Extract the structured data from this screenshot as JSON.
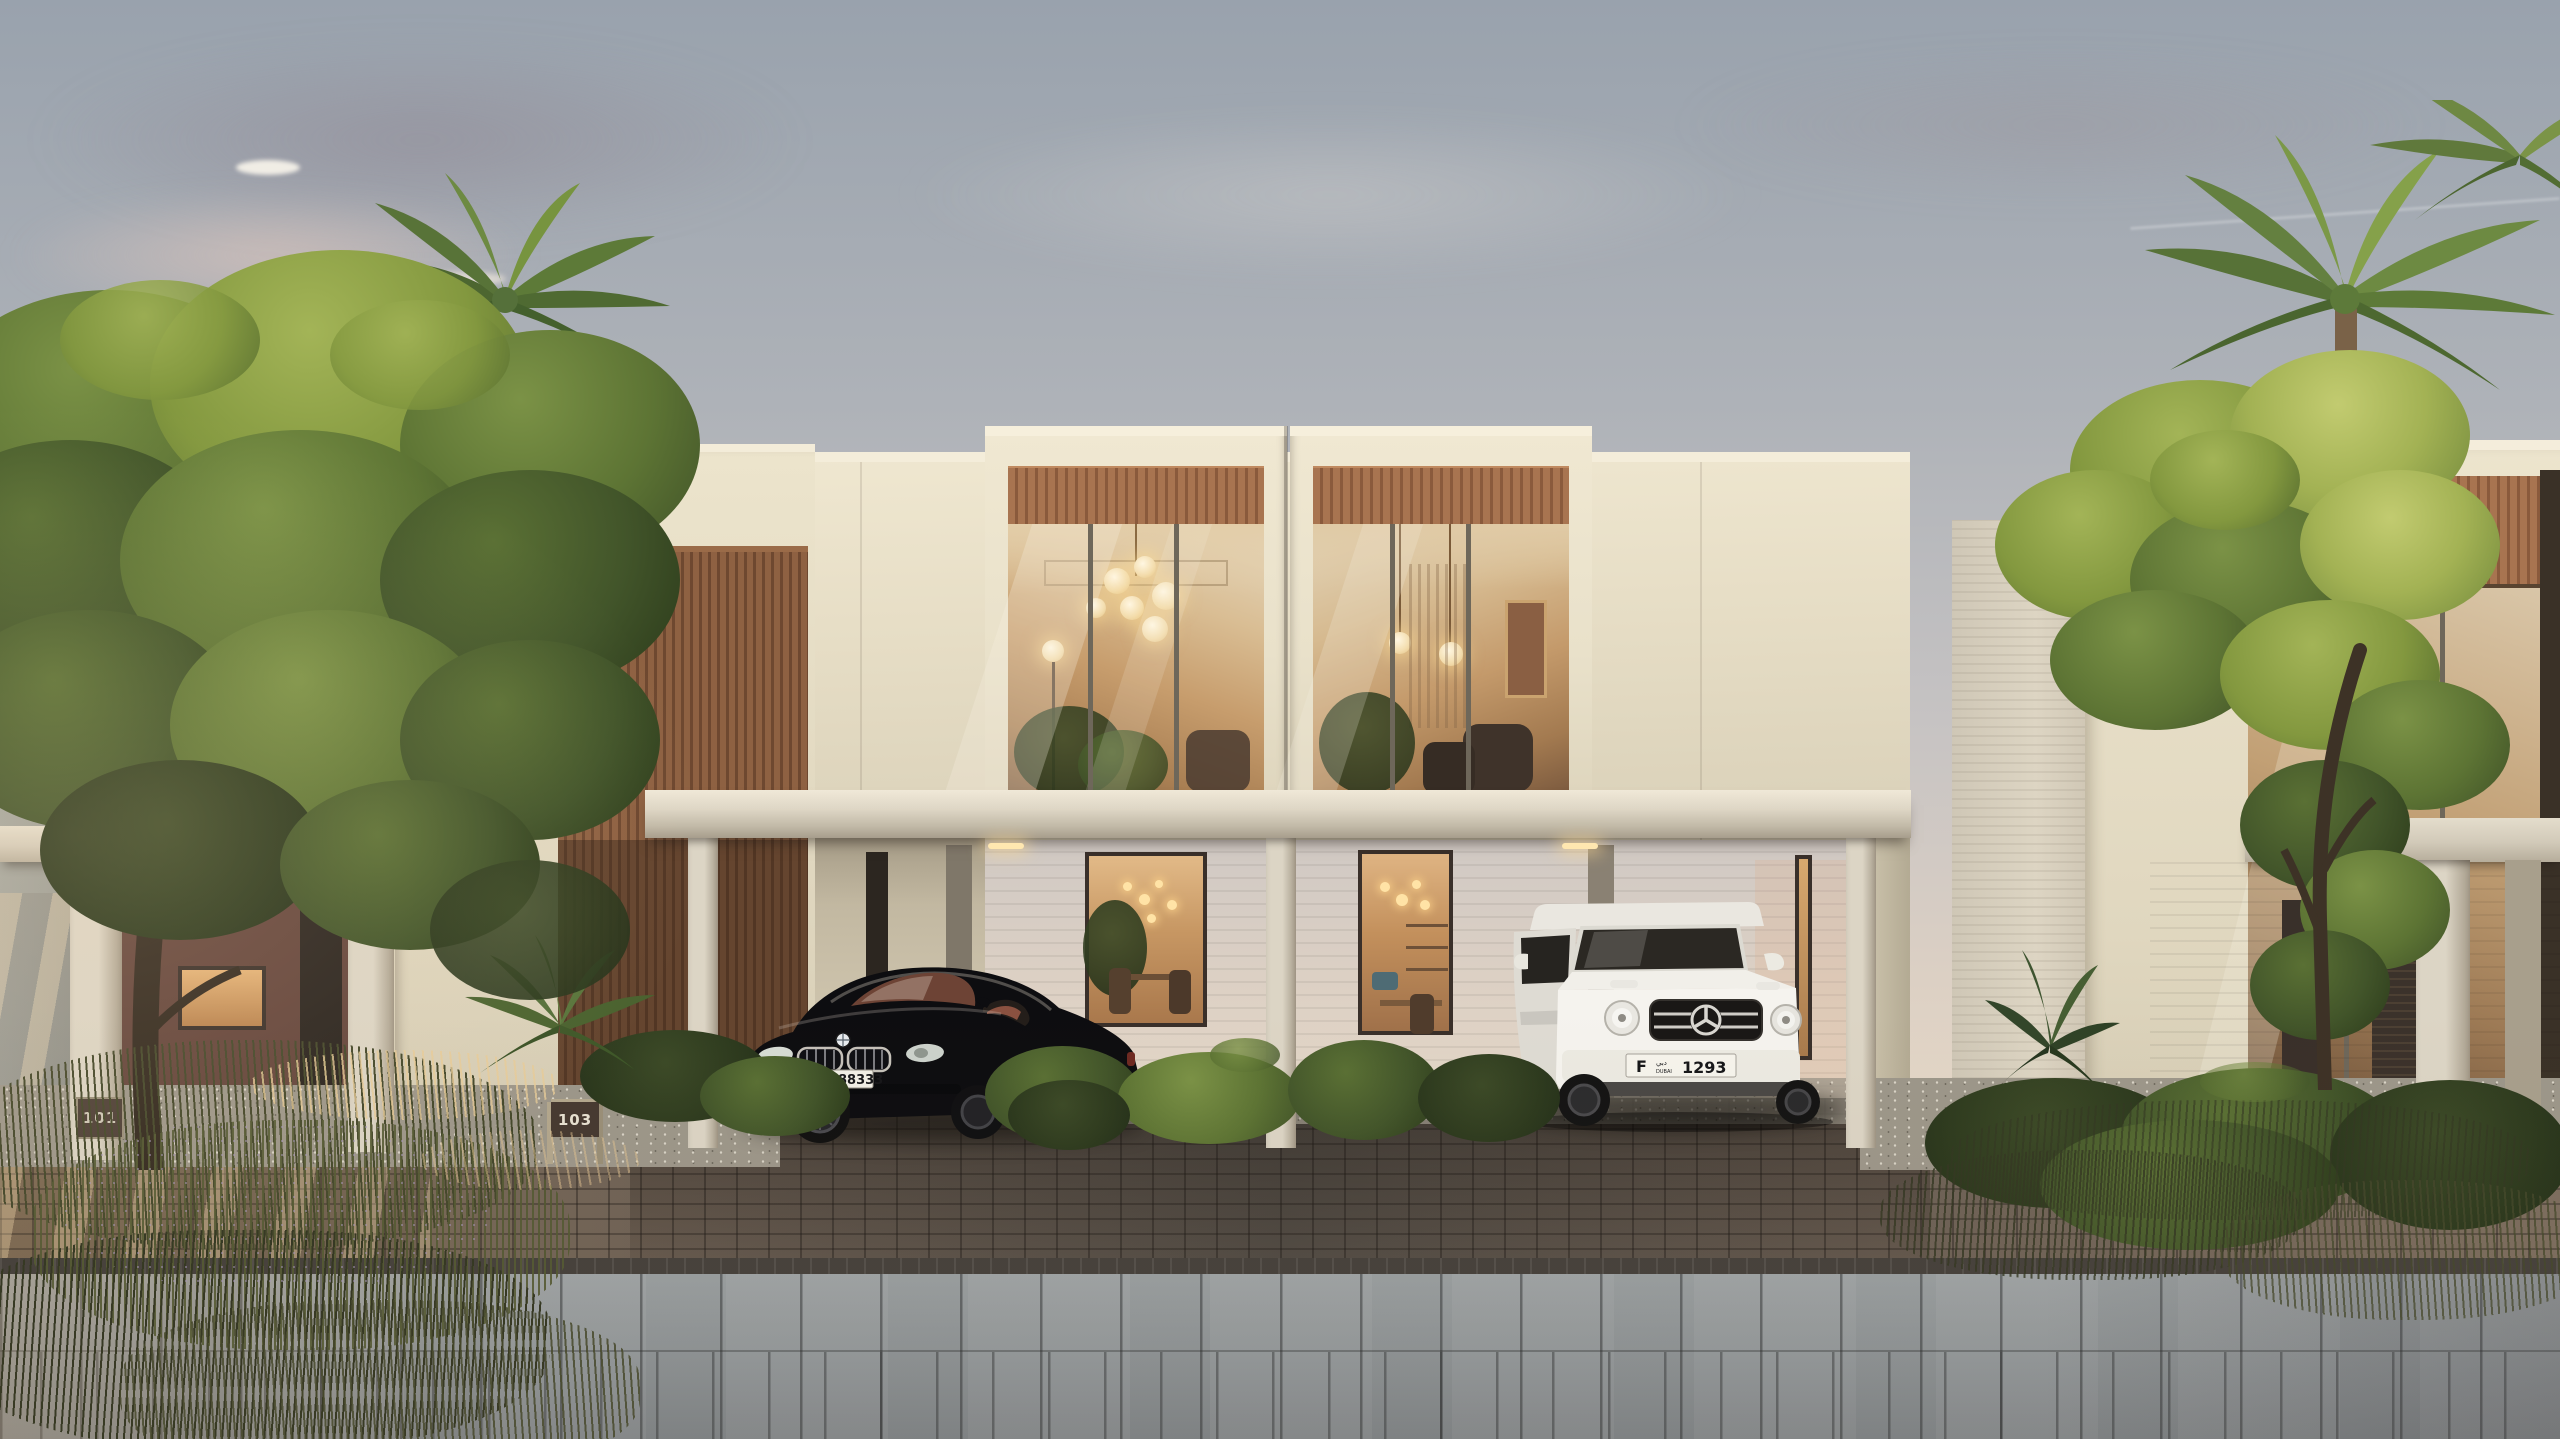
{
  "scene": {
    "type": "architectural exterior rendering",
    "description": "Golden-hour rendering of a modern two-storey townhouse terrace with cream stone facades, timber slat accents, terracotta entry walls, full-height glazing, shared carport canopy with two parked cars, palms and desert-style planting",
    "time_of_day": "sunset golden hour",
    "sky": "hazy grey-blue fading to warm peach with faint pink clouds and a thin contrail"
  },
  "residences": {
    "style": "contemporary townhouses, cream limestone, timber louvres, terracotta ground walls",
    "house_plaques": [
      {
        "number": "101"
      },
      {
        "number": "103"
      },
      {
        "number": "105"
      },
      {
        "number": "107"
      }
    ],
    "lighting": "warm interiors with globe chandelier, brass cage pendants, glowing floor lamp and pendant clusters over dining tables"
  },
  "vehicles": [
    {
      "type": "black luxury coupe",
      "interior": "red-brown leather",
      "plate": {
        "category": "C",
        "city_arabic": "دبي",
        "city": "DUBAI",
        "number": "88333"
      }
    },
    {
      "type": "white luxury SUV",
      "emblem": "three-pointed star",
      "plate": {
        "category": "F",
        "city_arabic": "دبي",
        "city": "DUBAI",
        "number": "1293"
      }
    }
  ],
  "landscape": {
    "elements": [
      "leafy green tree",
      "date palms",
      "yellow-green acacia tree",
      "ornamental grasses with lavender",
      "clipped shrubs",
      "white pebble gravel beds"
    ],
    "paving": [
      "brick paver driveway",
      "dark drainage channel",
      "grey plank paver street"
    ]
  },
  "palette": {
    "sky_top": "#9ba4ae",
    "sky_horizon": "#efe0cb",
    "facade_cream": "#eae2cb",
    "timber": "#a5714c",
    "entry_wall_terracotta": "#83594d",
    "canopy": "#ded6c5",
    "glass_glow": "#c79d6d",
    "foliage_green": "#55682f",
    "foliage_yellow_green": "#a9b85a",
    "paver_brick": "#6f665e",
    "paver_concrete": "#8b9194"
  }
}
